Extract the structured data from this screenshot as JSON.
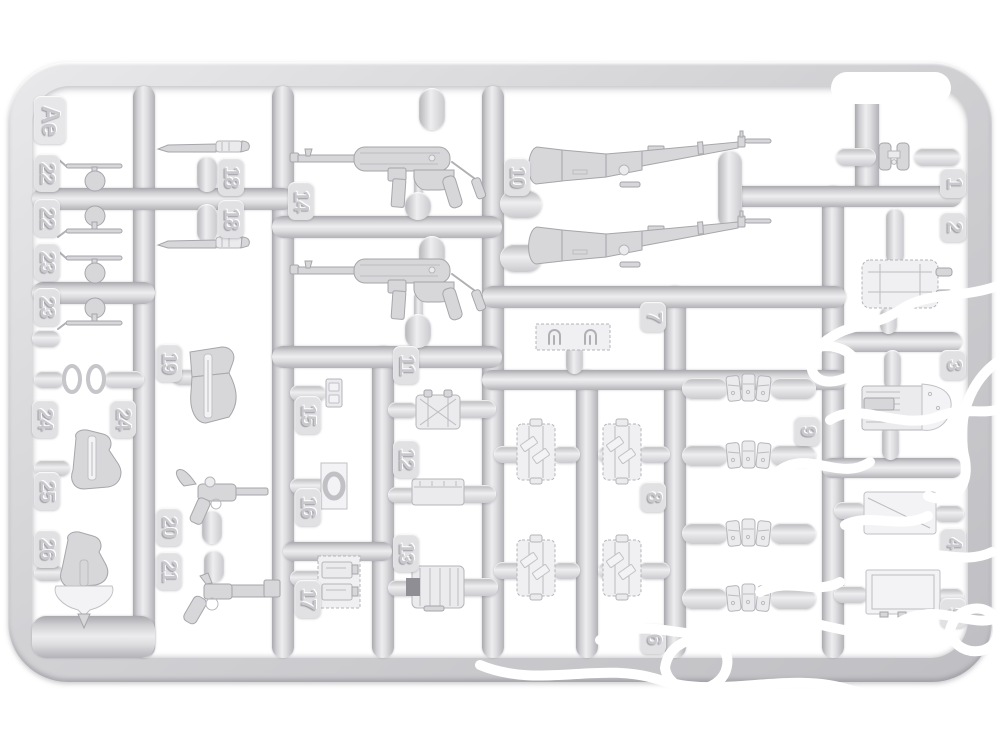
{
  "sprue": {
    "plate_letter": "Ae",
    "numbers": {
      "n1": "1",
      "n2": "2",
      "n3": "3",
      "n4": "4",
      "n5": "5",
      "n6": "6",
      "n7": "7",
      "n8": "8",
      "n9": "9",
      "n10": "10",
      "n11": "11",
      "n12": "12",
      "n13": "13",
      "n14": "14",
      "n15": "15",
      "n16": "16",
      "n17": "17",
      "n18": "18",
      "n19": "19",
      "n20": "20",
      "n21": "21",
      "n22": "22",
      "n23": "23",
      "n24": "24",
      "n25": "25",
      "n26": "26"
    }
  },
  "colors": {
    "background": "#ffffff",
    "plastic": "#d6d6d9",
    "plastic_shadow": "#aaaaaf",
    "plastic_highlight": "#efeff1",
    "watermark": "#ffffff"
  }
}
